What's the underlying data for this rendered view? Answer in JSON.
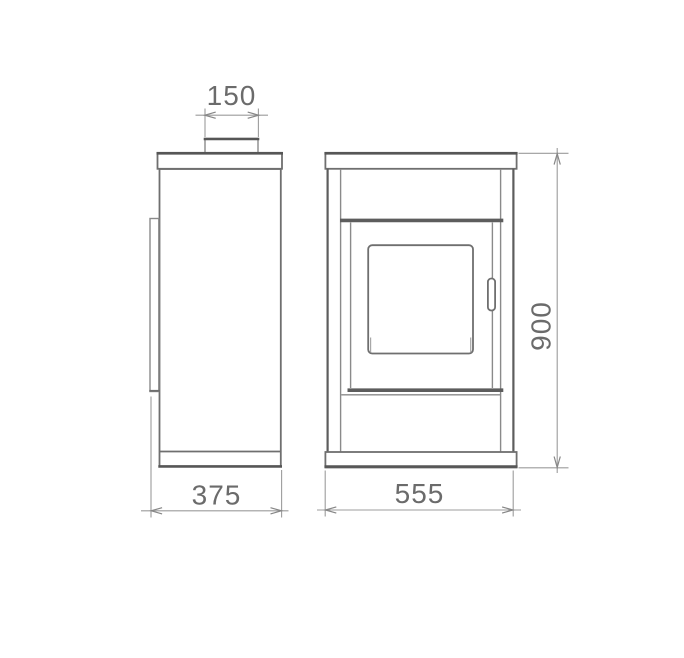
{
  "colors": {
    "background": "#ffffff",
    "outline_strong": "#565656",
    "outline_light": "#8a8a8a",
    "dimension_line": "#9c9c9c",
    "dimension_text": "#6b6b6b"
  },
  "dimensions": {
    "flue": {
      "label": "150"
    },
    "depth": {
      "label": "375"
    },
    "width": {
      "label": "555"
    },
    "height": {
      "label": "900"
    }
  }
}
